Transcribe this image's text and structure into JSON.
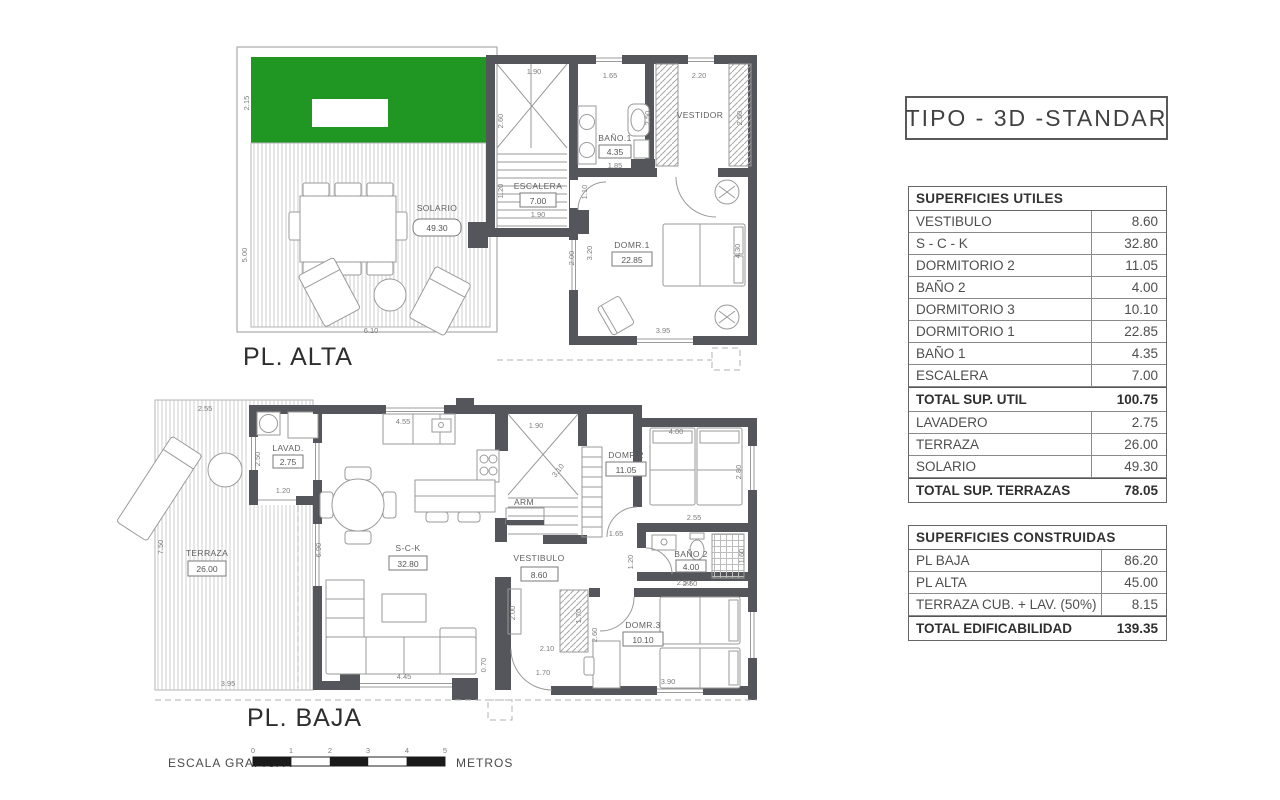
{
  "title": "TIPO - 3D -STANDAR",
  "colors": {
    "green_lawn": "#1f9722",
    "wall_gray": "#54565b",
    "scale_black": "#1a1a1a"
  },
  "plan_alta": {
    "label": "PL. ALTA",
    "solario": {
      "name": "SOLARIO",
      "area": "49.30",
      "width": "6.10",
      "height": "5.00",
      "green_height": "2.15"
    },
    "escalera": {
      "name": "ESCALERA",
      "area": "7.00",
      "top": "1.90",
      "left": "2.60",
      "left2": "1.20",
      "bottom": "1.90"
    },
    "bano1": {
      "name": "BAÑO.1",
      "area": "4.35",
      "top": "1.65",
      "bottom": "1.85",
      "right": "2.50"
    },
    "vestidor": {
      "name": "VESTIDOR",
      "top": "2.20",
      "right": "2.50"
    },
    "dorm1": {
      "name": "DOMR.1",
      "area": "22.85",
      "left": "3.20",
      "left_outer": "2.00",
      "right": "4.30",
      "bottom": "3.95",
      "door": "1.10"
    }
  },
  "plan_baja": {
    "label": "PL. BAJA",
    "terraza": {
      "name": "TERRAZA",
      "area": "26.00",
      "top": "2.55",
      "left": "7.50",
      "bottom": "3.95"
    },
    "lavadero": {
      "name": "LAVAD.",
      "area": "2.75",
      "left": "2.50",
      "bottom": "1.20"
    },
    "sck": {
      "name": "S-C-K",
      "area": "32.80",
      "kitchen_top": "4.55",
      "left": "6.90",
      "sofa_bottom": "4.45",
      "bottom_wall": "0.70",
      "closet": "2.00"
    },
    "vestibulo": {
      "name": "VESTIBULO",
      "area": "8.60",
      "door_w": "2.10",
      "door": "1.70"
    },
    "stairs": {
      "top": "1.90",
      "diag": "3.10"
    },
    "arm": {
      "name": "ARM"
    },
    "dorm2": {
      "name": "DOMR.2",
      "area": "11.05",
      "top": "4.00",
      "right": "2.80",
      "door": "1.65"
    },
    "bano2": {
      "name": "BAÑO 2",
      "area": "4.00",
      "top": "2.55",
      "left": "1.20",
      "right": "1.60",
      "bottom": "2.50"
    },
    "dorm3": {
      "name": "DOMR.3",
      "area": "10.10",
      "top": "2.50",
      "left": "2.60",
      "door": "1.70",
      "bottom": "3.90"
    }
  },
  "tables": {
    "utiles": {
      "header": "SUPERFICIES UTILES",
      "rows": [
        {
          "label": "VESTIBULO",
          "value": "8.60"
        },
        {
          "label": "S - C - K",
          "value": "32.80"
        },
        {
          "label": "DORMITORIO 2",
          "value": "11.05"
        },
        {
          "label": "BAÑO 2",
          "value": "4.00"
        },
        {
          "label": "DORMITORIO 3",
          "value": "10.10"
        },
        {
          "label": "DORMITORIO 1",
          "value": "22.85"
        },
        {
          "label": "BAÑO 1",
          "value": "4.35"
        },
        {
          "label": "ESCALERA",
          "value": "7.00"
        }
      ],
      "total_util": {
        "label": "TOTAL SUP. UTIL",
        "value": "100.75"
      },
      "terrace_rows": [
        {
          "label": "LAVADERO",
          "value": "2.75"
        },
        {
          "label": "TERRAZA",
          "value": "26.00"
        },
        {
          "label": "SOLARIO",
          "value": "49.30"
        }
      ],
      "total_terrazas": {
        "label": "TOTAL SUP. TERRAZAS",
        "value": "78.05"
      }
    },
    "construidas": {
      "header": "SUPERFICIES CONSTRUIDAS",
      "rows": [
        {
          "label": "PL BAJA",
          "value": "86.20"
        },
        {
          "label": "PL ALTA",
          "value": "45.00"
        },
        {
          "label": "TERRAZA CUB. + LAV. (50%)",
          "value": "8.15"
        }
      ],
      "total": {
        "label": "TOTAL EDIFICABILIDAD",
        "value": "139.35"
      }
    }
  },
  "scale_bar": {
    "label": "ESCALA GRAFICA :",
    "unit": "METROS",
    "ticks": [
      "0",
      "1",
      "2",
      "3",
      "4",
      "5"
    ]
  }
}
